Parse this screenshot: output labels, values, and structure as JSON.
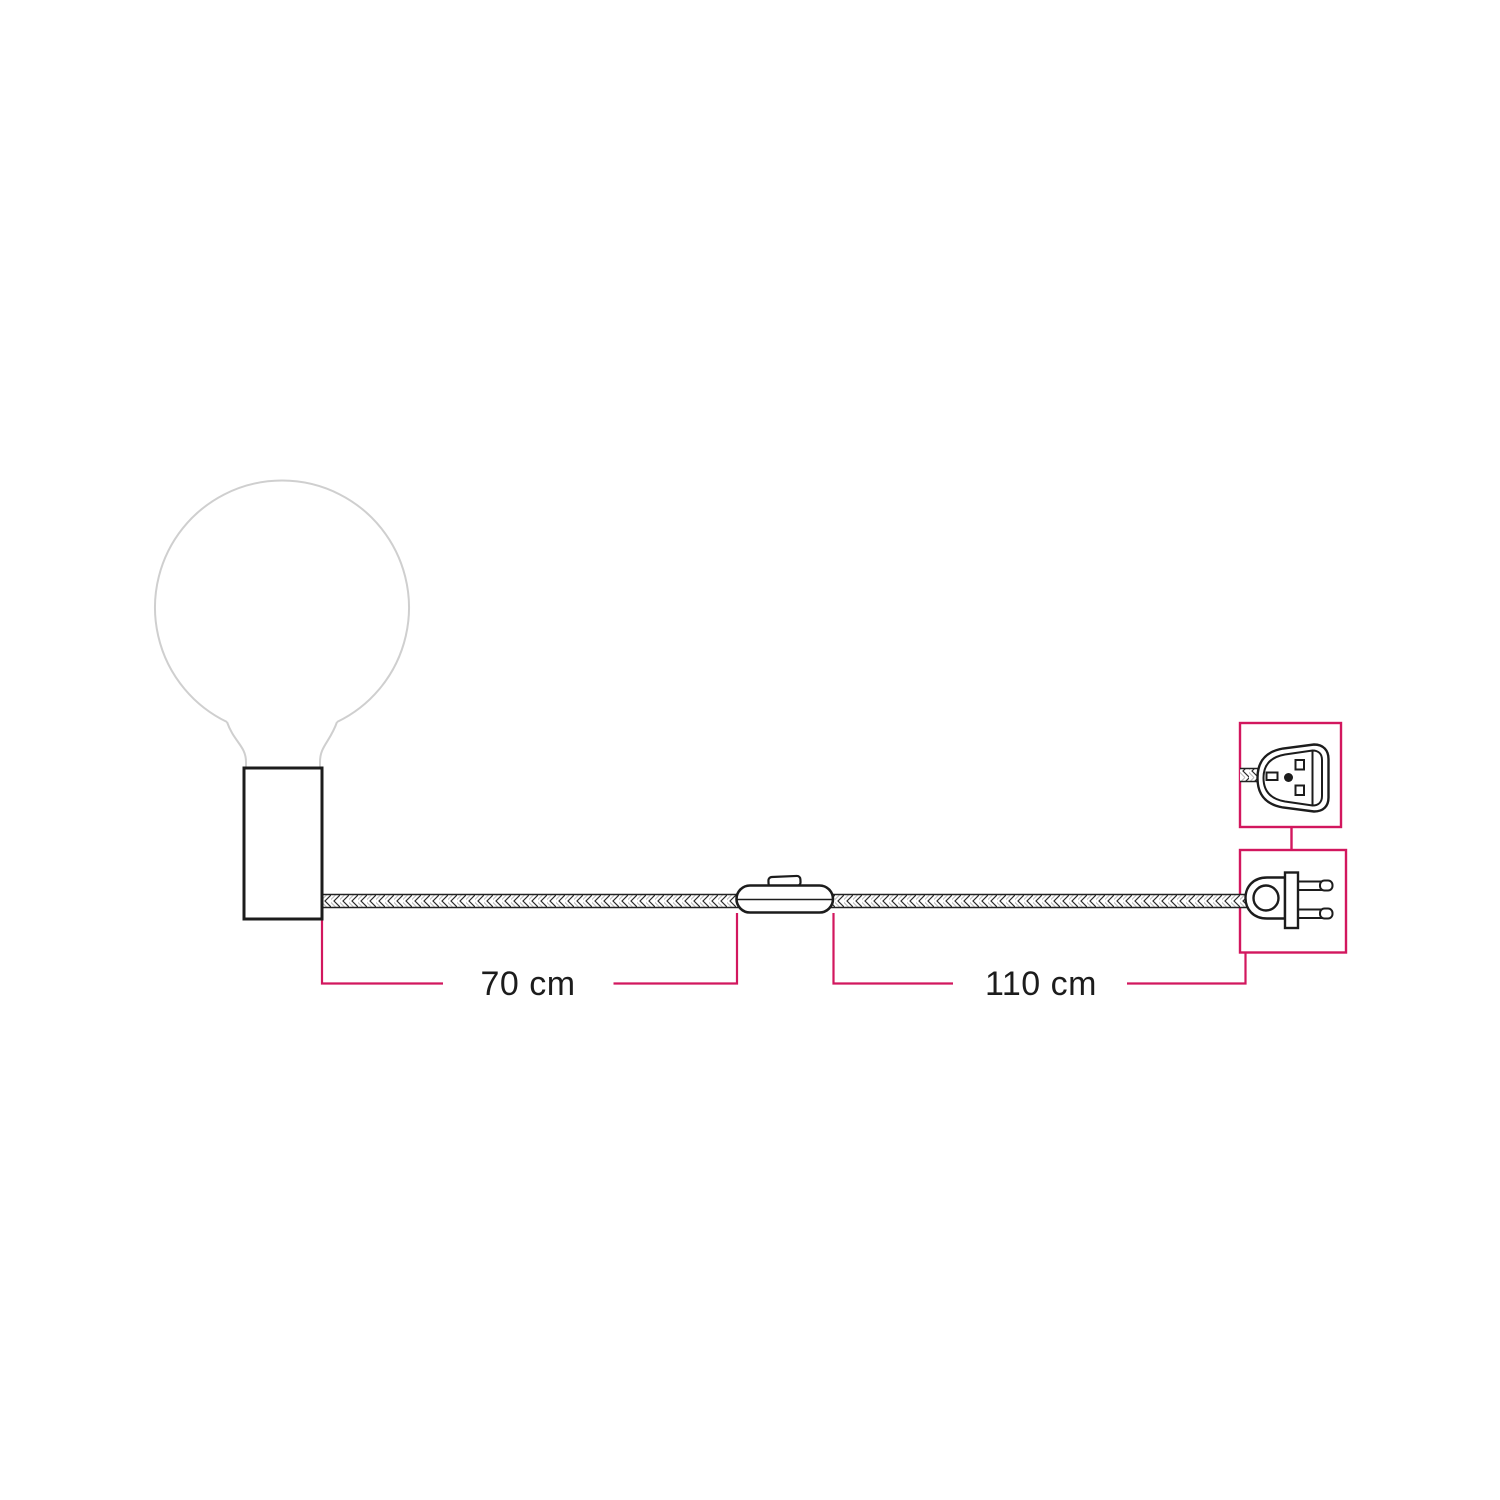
{
  "diagram": {
    "type": "product-dimension-diagram",
    "components": [
      "light-bulb-globe-icon",
      "lamp-holder-icon",
      "braided-cable-icon",
      "inline-switch-icon",
      "two-pin-plug-side-icon",
      "two-pin-plug-front-icon",
      "detail-callout-box-top",
      "detail-callout-box-bottom"
    ],
    "dimensions": {
      "segment_1": {
        "label": "70 cm",
        "value": 70,
        "unit": "cm"
      },
      "segment_2": {
        "label": "110 cm",
        "value": 110,
        "unit": "cm"
      }
    }
  },
  "colors": {
    "accent": "#d2175e",
    "ink": "#1c1c1c",
    "bulb_outline": "#cfcfcf",
    "background": "#ffffff"
  }
}
